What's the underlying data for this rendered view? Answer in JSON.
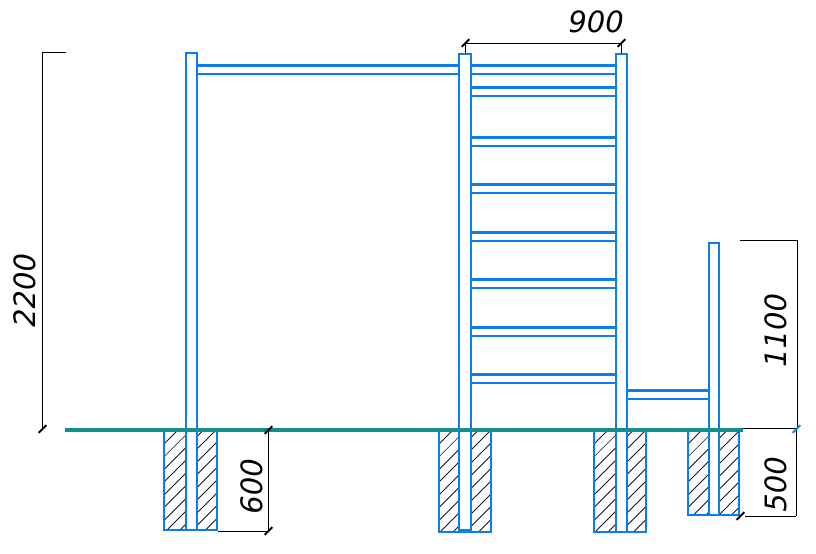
{
  "labels": {
    "top_width": "900",
    "left_height": "2200",
    "right_height": "1100",
    "left_foundation_depth": "600",
    "right_foundation_depth": "500"
  },
  "colors": {
    "structure_blue": "#0a7cf0",
    "ground_teal": "#0e8f8a",
    "dimension_ink": "#000000"
  },
  "structure_counts": {
    "ladder_rungs": 8,
    "foundation_blocks": 4,
    "posts": 4
  }
}
